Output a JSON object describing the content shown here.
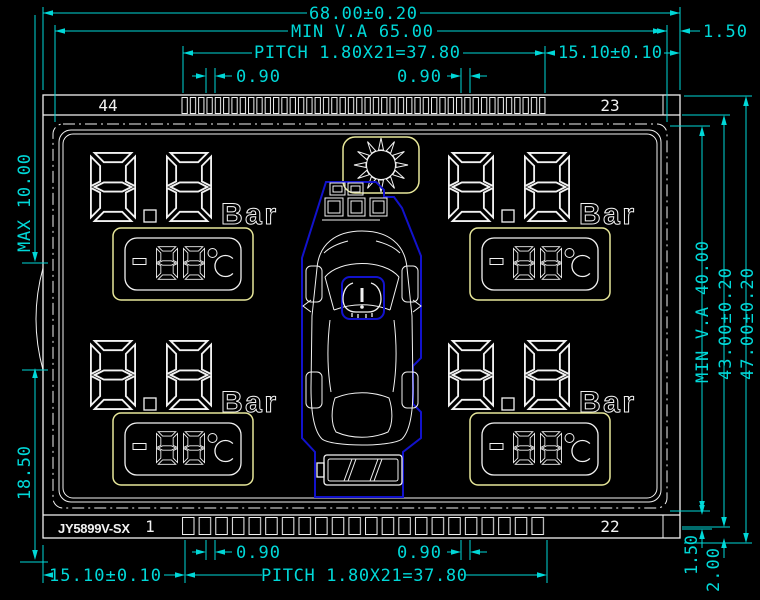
{
  "drawing": {
    "part_number": "JY5899V-SX",
    "colors": {
      "background": "#000000",
      "line": "#f2f2f2",
      "dimension": "#00d8d8",
      "highlight_yellow": "#e8e89a",
      "highlight_blue": "#1212cc"
    },
    "dimensions_top": {
      "overall_width": "68.00±0.20",
      "min_viewing_width": "MIN V.A 65.00",
      "right_margin": "1.50",
      "pin_pitch": "PITCH 1.80X21=37.80",
      "pin_edge_offset": "15.10±0.10",
      "pin_width_left": "0.90",
      "pin_width_right": "0.90"
    },
    "dimensions_bottom": {
      "pin_width_left": "0.90",
      "pin_width_right": "0.90",
      "pin_edge_offset": "15.10±0.10",
      "pin_pitch": "PITCH 1.80X21=37.80",
      "margin_inner": "1.50",
      "margin_outer": "2.00"
    },
    "dimensions_left": {
      "max_offset": "MAX 10.00",
      "tab_offset": "18.50"
    },
    "dimensions_right": {
      "min_viewing_height": "MIN V.A 40.00",
      "glass_height": "43.00±0.20",
      "overall_height": "47.00±0.20"
    },
    "pins": {
      "top_left": "44",
      "top_right": "23",
      "bottom_left": "1",
      "bottom_right": "22"
    }
  },
  "lcd": {
    "quadrants": [
      {
        "position": "top-left",
        "pressure": "8.8",
        "pressure_unit": "Bar",
        "temperature": "-88",
        "temperature_unit": "°C"
      },
      {
        "position": "top-right",
        "pressure": "8.8",
        "pressure_unit": "Bar",
        "temperature": "-88",
        "temperature_unit": "°C"
      },
      {
        "position": "bottom-left",
        "pressure": "8.8",
        "pressure_unit": "Bar",
        "temperature": "-88",
        "temperature_unit": "°C"
      },
      {
        "position": "bottom-right",
        "pressure": "8.8",
        "pressure_unit": "Bar",
        "temperature": "-88",
        "temperature_unit": "°C"
      }
    ],
    "icons": [
      {
        "name": "sun-icon"
      },
      {
        "name": "car-top-view-icon"
      },
      {
        "name": "tpms-warning-icon"
      },
      {
        "name": "battery-icon"
      },
      {
        "name": "mode-squares-icon"
      }
    ]
  }
}
